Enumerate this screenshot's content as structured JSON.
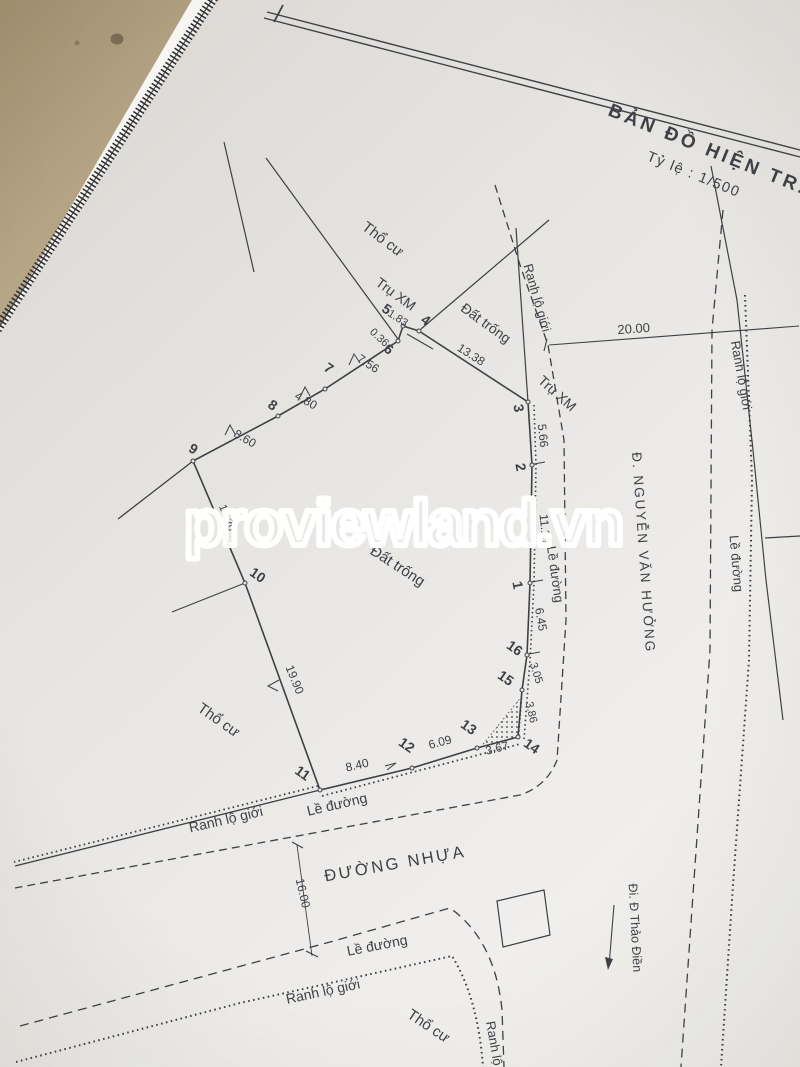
{
  "photo": {
    "table_color": "#b2a183",
    "paper_color": "#e7e5e2",
    "ink_color": "#3d4046"
  },
  "title_block": {
    "title": "BẢN ĐỒ HIỆN TRẠNG",
    "scale": "Tỷ lệ : 1/500"
  },
  "watermark": {
    "text": "proviewland.vn",
    "color": "#ffffff"
  },
  "streets": {
    "main": "Đ. NGUYỄN VĂN HƯỞNG",
    "bottom": "ĐƯỜNG NHỰA",
    "direction": "Đi. Đ Thảo Điền"
  },
  "labels": {
    "residential": "Thổ cư",
    "vacant": "Đất trống",
    "post": "Trụ XM",
    "row_boundary": "Ranh lộ giới",
    "road_edge": "Lề đường"
  },
  "points": {
    "p1": "1",
    "p2": "2",
    "p3": "3",
    "p4": "4",
    "p5": "5",
    "p6": "6",
    "p7": "7",
    "p8": "8",
    "p9": "9",
    "p10": "10",
    "p11": "11",
    "p12": "12",
    "p13": "13",
    "p14": "14",
    "p15": "15",
    "p16": "16"
  },
  "measurements": {
    "m_5_4": "1.83",
    "m_5_6": "0.36",
    "m_6_7": "7.56",
    "m_7_8": "4.80",
    "m_8_9": "8.60",
    "m_4_3": "13.38",
    "m_3_2": "5.66",
    "m_2_1": "11.13",
    "m_1_16": "6.45",
    "m_16_15": "3.05",
    "m_15_14": "3.86",
    "m_14_13": "3.67",
    "m_13_12": "6.09",
    "m_12_11": "8.40",
    "m_10_11": "19.90",
    "m_9_10": "14.20",
    "m_top": "20.00",
    "m_road_width": "16.00"
  }
}
